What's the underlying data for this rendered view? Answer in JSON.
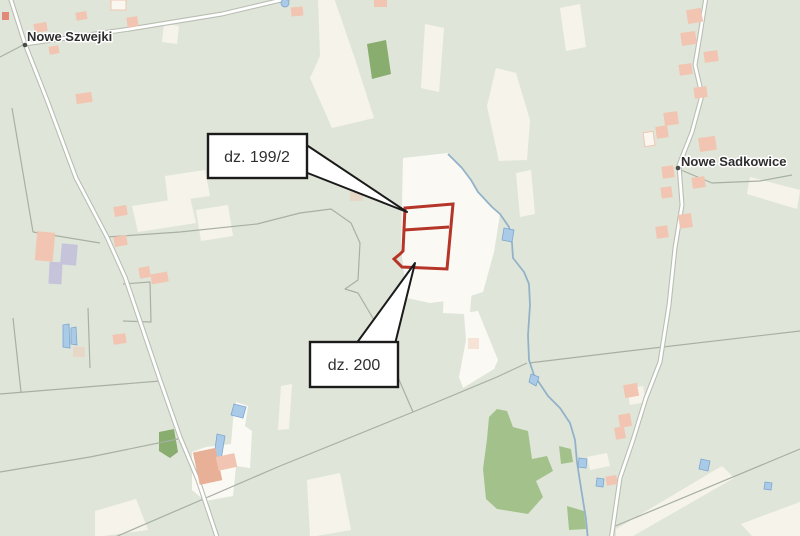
{
  "map": {
    "labels": {
      "nowe_szwejki": "Nowe Szwejki",
      "nowe_sadkowice": "Nowe Sadkowice"
    },
    "callouts": {
      "parcel_199_2": "dz. 199/2",
      "parcel_200": "dz. 200"
    },
    "colors": {
      "background": "#dfe6d9",
      "field": "#f6f3eb",
      "field_bright": "#fbf9f4",
      "forest": "#88ad6f",
      "forest_light": "#a3c28b",
      "water_line": "#93b2c9",
      "water_fill": "#a9cbe8",
      "water_stroke": "#7fa6cf",
      "road_casing": "#b9beb3",
      "road_fill": "#ffffff",
      "boundary": "#a8b0a3",
      "building": "#f1c5b1",
      "building_red": "#e2897a",
      "building_purple": "#c6c4da",
      "building_farm": "#e8b096",
      "parcel": "#b53629",
      "callout_bg": "#ffffff",
      "callout_border": "#1b1b1b",
      "callout_text": "#2f2f2f",
      "label": "#2e2e2e",
      "halo": "#ffffff",
      "dot": "#4a4a4a"
    }
  }
}
